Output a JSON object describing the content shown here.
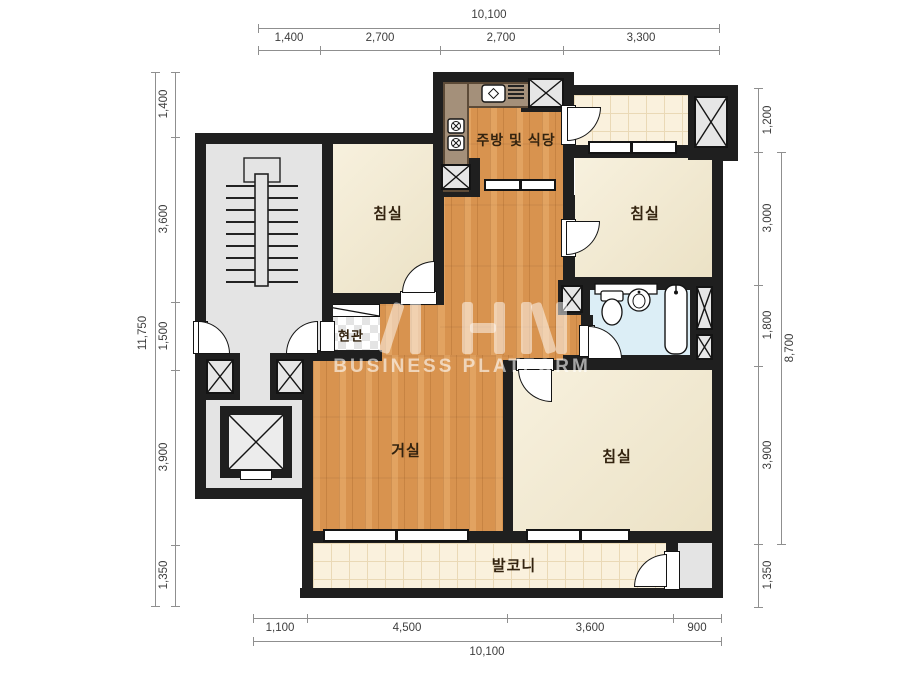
{
  "watermark": {
    "brand": "AHN",
    "subtitle": "BUSINESS PLATFORM"
  },
  "rooms": {
    "kitchen": {
      "label": "주방 및 식당"
    },
    "bedroom_top_left": {
      "label": "침실"
    },
    "bedroom_top_right": {
      "label": "침실"
    },
    "bedroom_bottom": {
      "label": "침실"
    },
    "entrance": {
      "label": "현관"
    },
    "living": {
      "label": "거실"
    },
    "balcony": {
      "label": "발코니"
    }
  },
  "dimensions": {
    "top": {
      "total": "10,100",
      "segments": [
        "1,400",
        "2,700",
        "2,700",
        "3,300"
      ]
    },
    "bottom": {
      "total": "10,100",
      "segments": [
        "1,100",
        "4,500",
        "3,600",
        "900"
      ]
    },
    "left": {
      "total": "11,750",
      "segments": [
        "1,400",
        "3,600",
        "1,500",
        "3,900",
        "1,350"
      ]
    },
    "right": {
      "total": "8,700",
      "segments": [
        "1,200",
        "3,000",
        "1,800",
        "3,900",
        "1,350"
      ]
    }
  },
  "colors": {
    "wall": "#1f1f1f",
    "wood": "#d8934f",
    "bedroom": "#f3e9cc",
    "bath": "#dceef6",
    "tile": "#faf1dd",
    "core": "#e4e4e4"
  }
}
